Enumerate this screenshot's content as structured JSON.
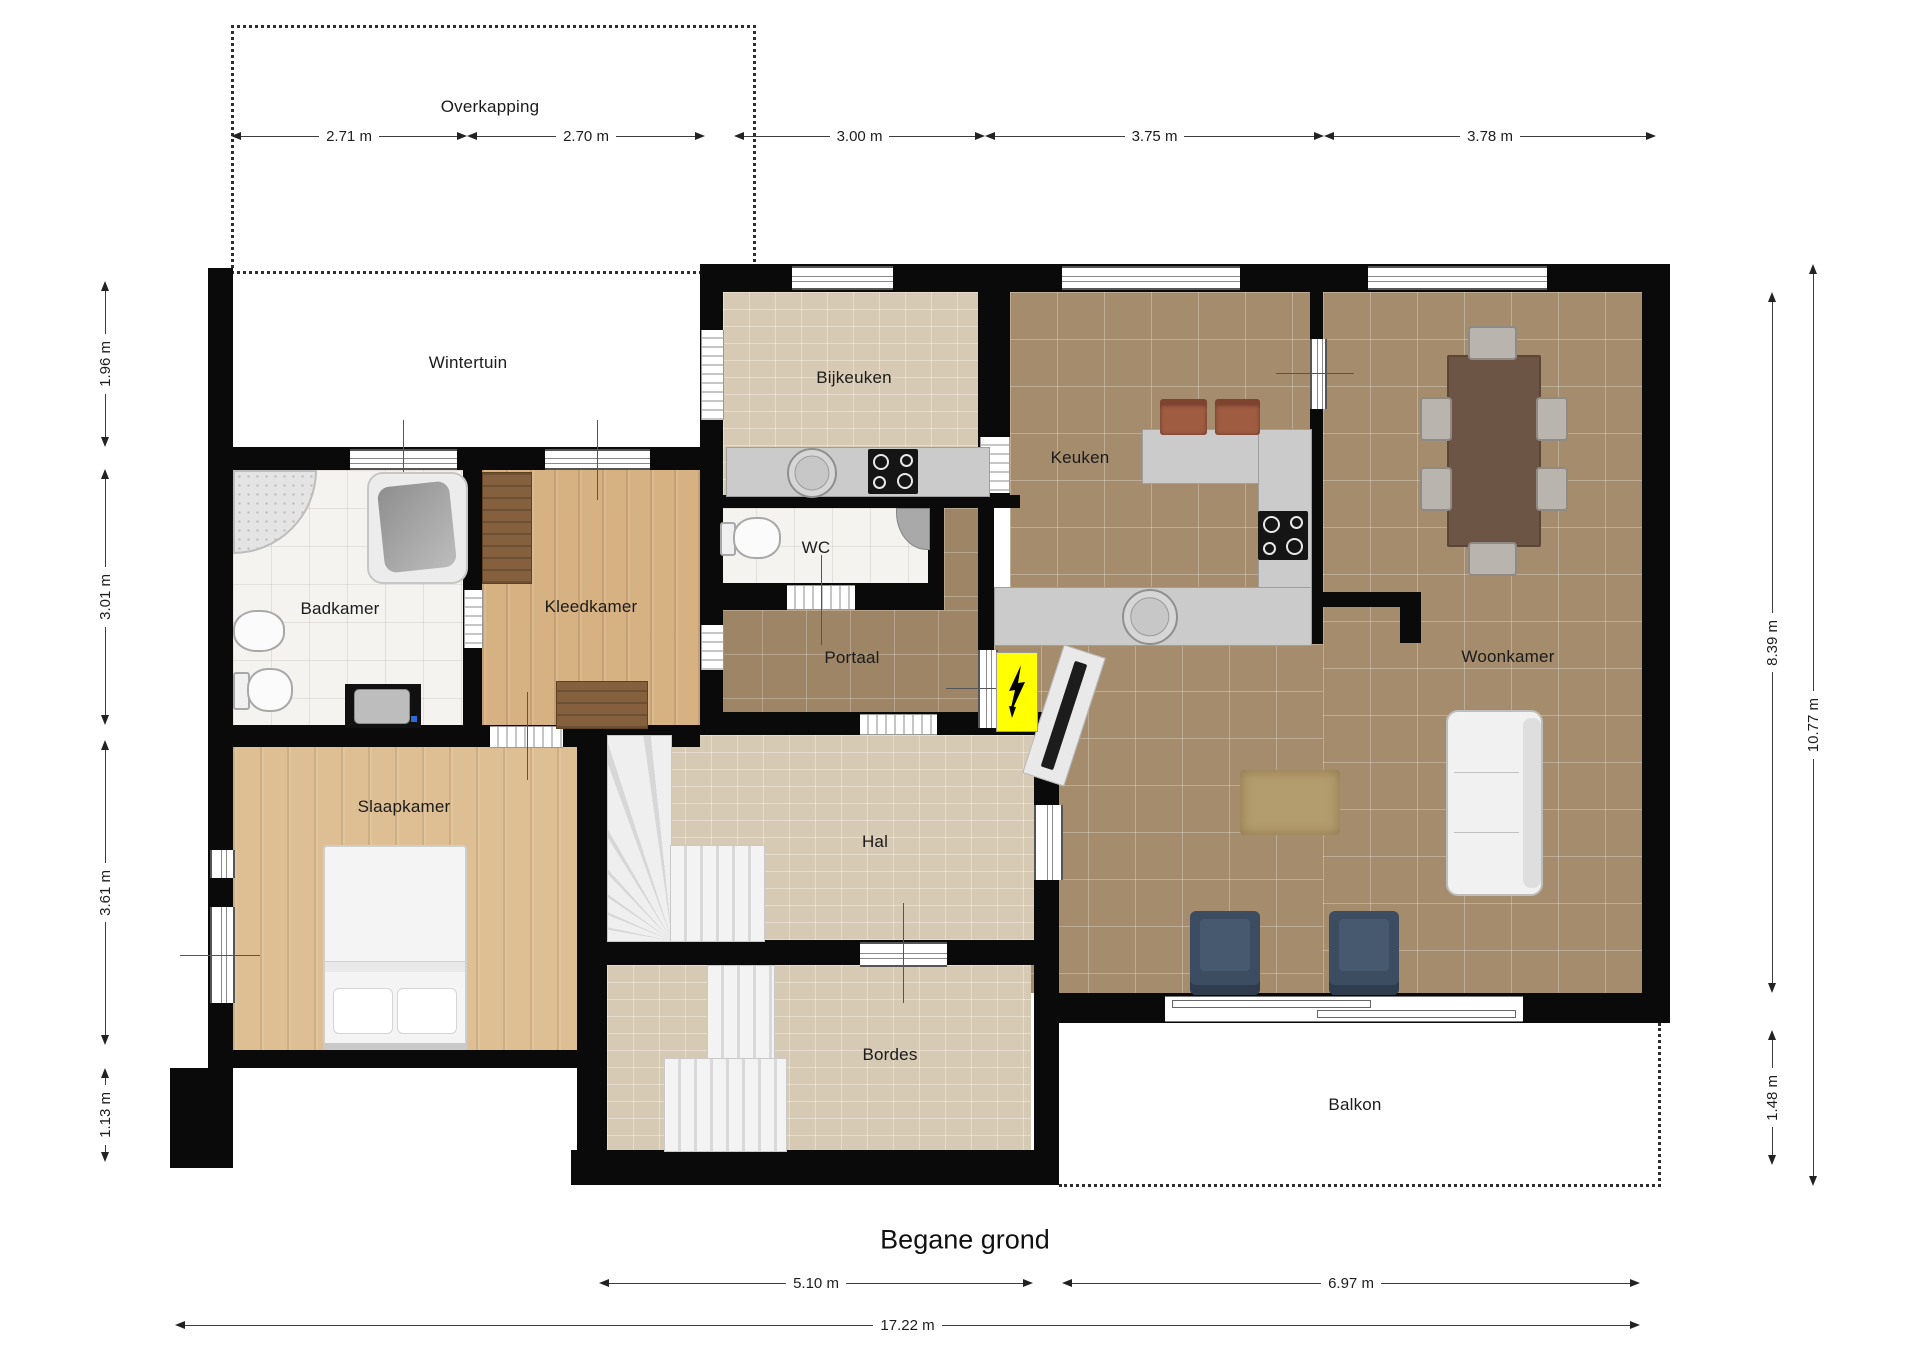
{
  "title": "Begane grond",
  "rooms": {
    "overkapping": "Overkapping",
    "wintertuin": "Wintertuin",
    "bijkeuken": "Bijkeuken",
    "keuken": "Keuken",
    "woonkamer": "Woonkamer",
    "badkamer": "Badkamer",
    "kleedkamer": "Kleedkamer",
    "wc": "WC",
    "portaal": "Portaal",
    "slaapkamer": "Slaapkamer",
    "hal": "Hal",
    "bordes": "Bordes",
    "balkon": "Balkon"
  },
  "dims": {
    "top": [
      "2.71 m",
      "2.70 m",
      "3.00 m",
      "3.75 m",
      "3.78 m"
    ],
    "left": [
      "1.96 m",
      "3.01 m",
      "3.61 m",
      "1.13 m"
    ],
    "right": [
      "8.39 m",
      "1.48 m",
      "10.77 m"
    ],
    "bottom": [
      "5.10 m",
      "6.97 m",
      "17.22 m"
    ]
  },
  "icons": {
    "electrical_panel": "lightning-bolt"
  },
  "colors": {
    "wall": "#0a0a0a",
    "tile_brown": "#a48c6c",
    "tile_light": "#d7cab4",
    "tile_white": "#f4f3f0",
    "wood": "#ddbf93",
    "counter_gray": "#cbcbcb",
    "electrical_yellow": "#ffff00",
    "armchair_blue": "#3c4d61",
    "stool_brown": "#a05c41"
  }
}
